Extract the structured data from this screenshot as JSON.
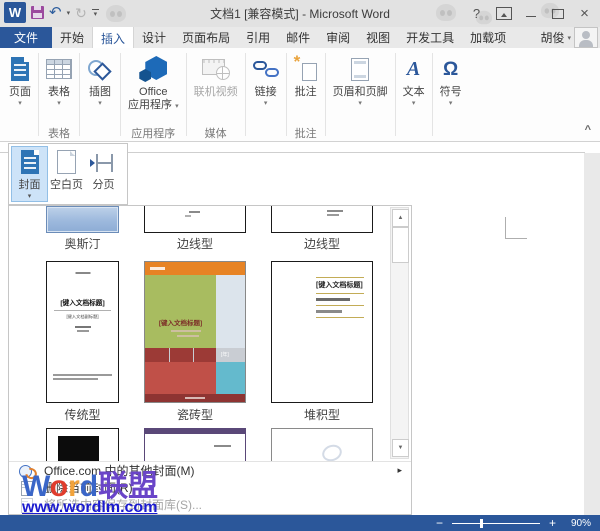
{
  "window": {
    "title": "文档1 [兼容模式] - Microsoft Word"
  },
  "icons": {
    "word_logo": "W",
    "undo": "↶",
    "redo": "↻",
    "dropdown": "▾",
    "help": "?",
    "close": "×",
    "collapse_ribbon": "^",
    "scroll_up": "▲",
    "scroll_down": "▼",
    "submenu": "▸",
    "omega": "Ω",
    "text_a": "A",
    "zoom_out": "−",
    "zoom_in": "+"
  },
  "tabs": {
    "file": "文件",
    "items": [
      {
        "label": "开始"
      },
      {
        "label": "插入"
      },
      {
        "label": "设计"
      },
      {
        "label": "页面布局"
      },
      {
        "label": "引用"
      },
      {
        "label": "邮件"
      },
      {
        "label": "审阅"
      },
      {
        "label": "视图"
      },
      {
        "label": "开发工具"
      },
      {
        "label": "加载项"
      }
    ],
    "user": "胡俊"
  },
  "ribbon": {
    "pages": "页面",
    "table": "表格",
    "table_group": "表格",
    "illustrations": "插图",
    "apps_line1": "Office",
    "apps_line2": "应用程序",
    "apps_group": "应用程序",
    "video": "联机视频",
    "media_group": "媒体",
    "links": "链接",
    "comment": "批注",
    "comment_group": "批注",
    "header_footer": "页眉和页脚",
    "text": "文本",
    "symbol": "符号"
  },
  "flyout": {
    "cover": "封面",
    "blank_page": "空白页",
    "page_break": "分页"
  },
  "gallery": {
    "row1_labels": [
      "奥斯汀",
      "边线型",
      "边线型"
    ],
    "row2_labels": [
      "传统型",
      "瓷砖型",
      "堆积型"
    ],
    "cover_title": "[键入文档标题]",
    "cover_subtitle": "[键入文档副标题]",
    "cover_year": "[年]"
  },
  "menu": {
    "more_covers": "Office.com 中的其他封面(M)",
    "remove_cover": "删除当前封面(R)",
    "save_selection": "将所选内容保存到封面库(S)..."
  },
  "status": {
    "zoom_level": "90%"
  },
  "watermark": {
    "letters": [
      {
        "ch": "W",
        "color": "#3a66c8"
      },
      {
        "ch": "o",
        "color": "#e03c2d"
      },
      {
        "ch": "r",
        "color": "#f2a33c"
      },
      {
        "ch": "d",
        "color": "#3a66c8"
      },
      {
        "ch": "联",
        "color": "#6a45c8"
      },
      {
        "ch": "盟",
        "color": "#6a45c8"
      }
    ],
    "url": "www.wordlm.com"
  },
  "colors": {
    "accent": "#2b579a",
    "status_bar": "#2b579a"
  }
}
